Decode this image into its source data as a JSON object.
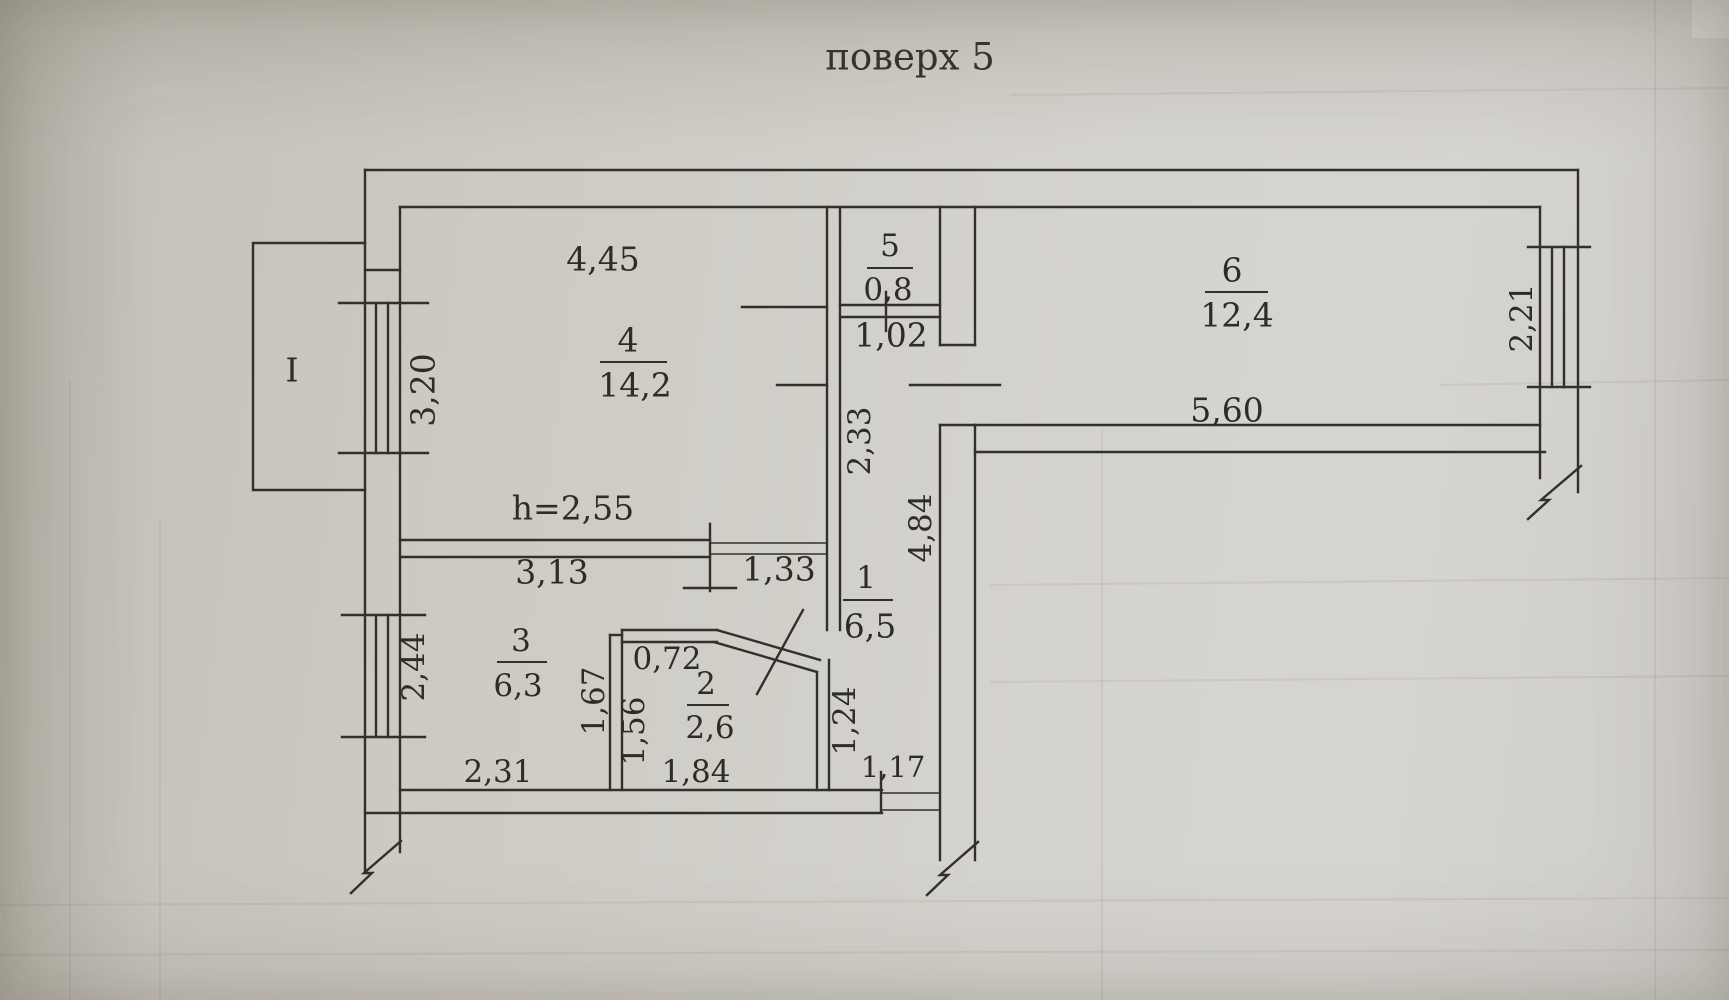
{
  "title": "поверх 5",
  "balcony": {
    "label": "I"
  },
  "rooms": {
    "r1": {
      "number": "1",
      "area": "6,5",
      "dim_top": "1,02",
      "dim_left": "2,33",
      "dim_right": "4,84",
      "dim_door": "1,33",
      "dim_entry": "1,17"
    },
    "r2": {
      "number": "2",
      "area": "2,6",
      "dim_top": "0,72",
      "dim_left": "1,56",
      "dim_right": "1,24",
      "dim_bottom": "1,84"
    },
    "r3": {
      "number": "3",
      "area": "6,3",
      "dim_top": "3,13",
      "dim_left": "2,44",
      "dim_right": "1,67",
      "dim_bottom": "2,31"
    },
    "r4": {
      "number": "4",
      "area": "14,2",
      "dim_top": "4,45",
      "dim_left": "3,20",
      "ceiling": "h=2,55"
    },
    "r5": {
      "number": "5",
      "area": "0,8"
    },
    "r6": {
      "number": "6",
      "area": "12,4",
      "dim_bottom": "5,60",
      "dim_right": "2,21"
    }
  }
}
